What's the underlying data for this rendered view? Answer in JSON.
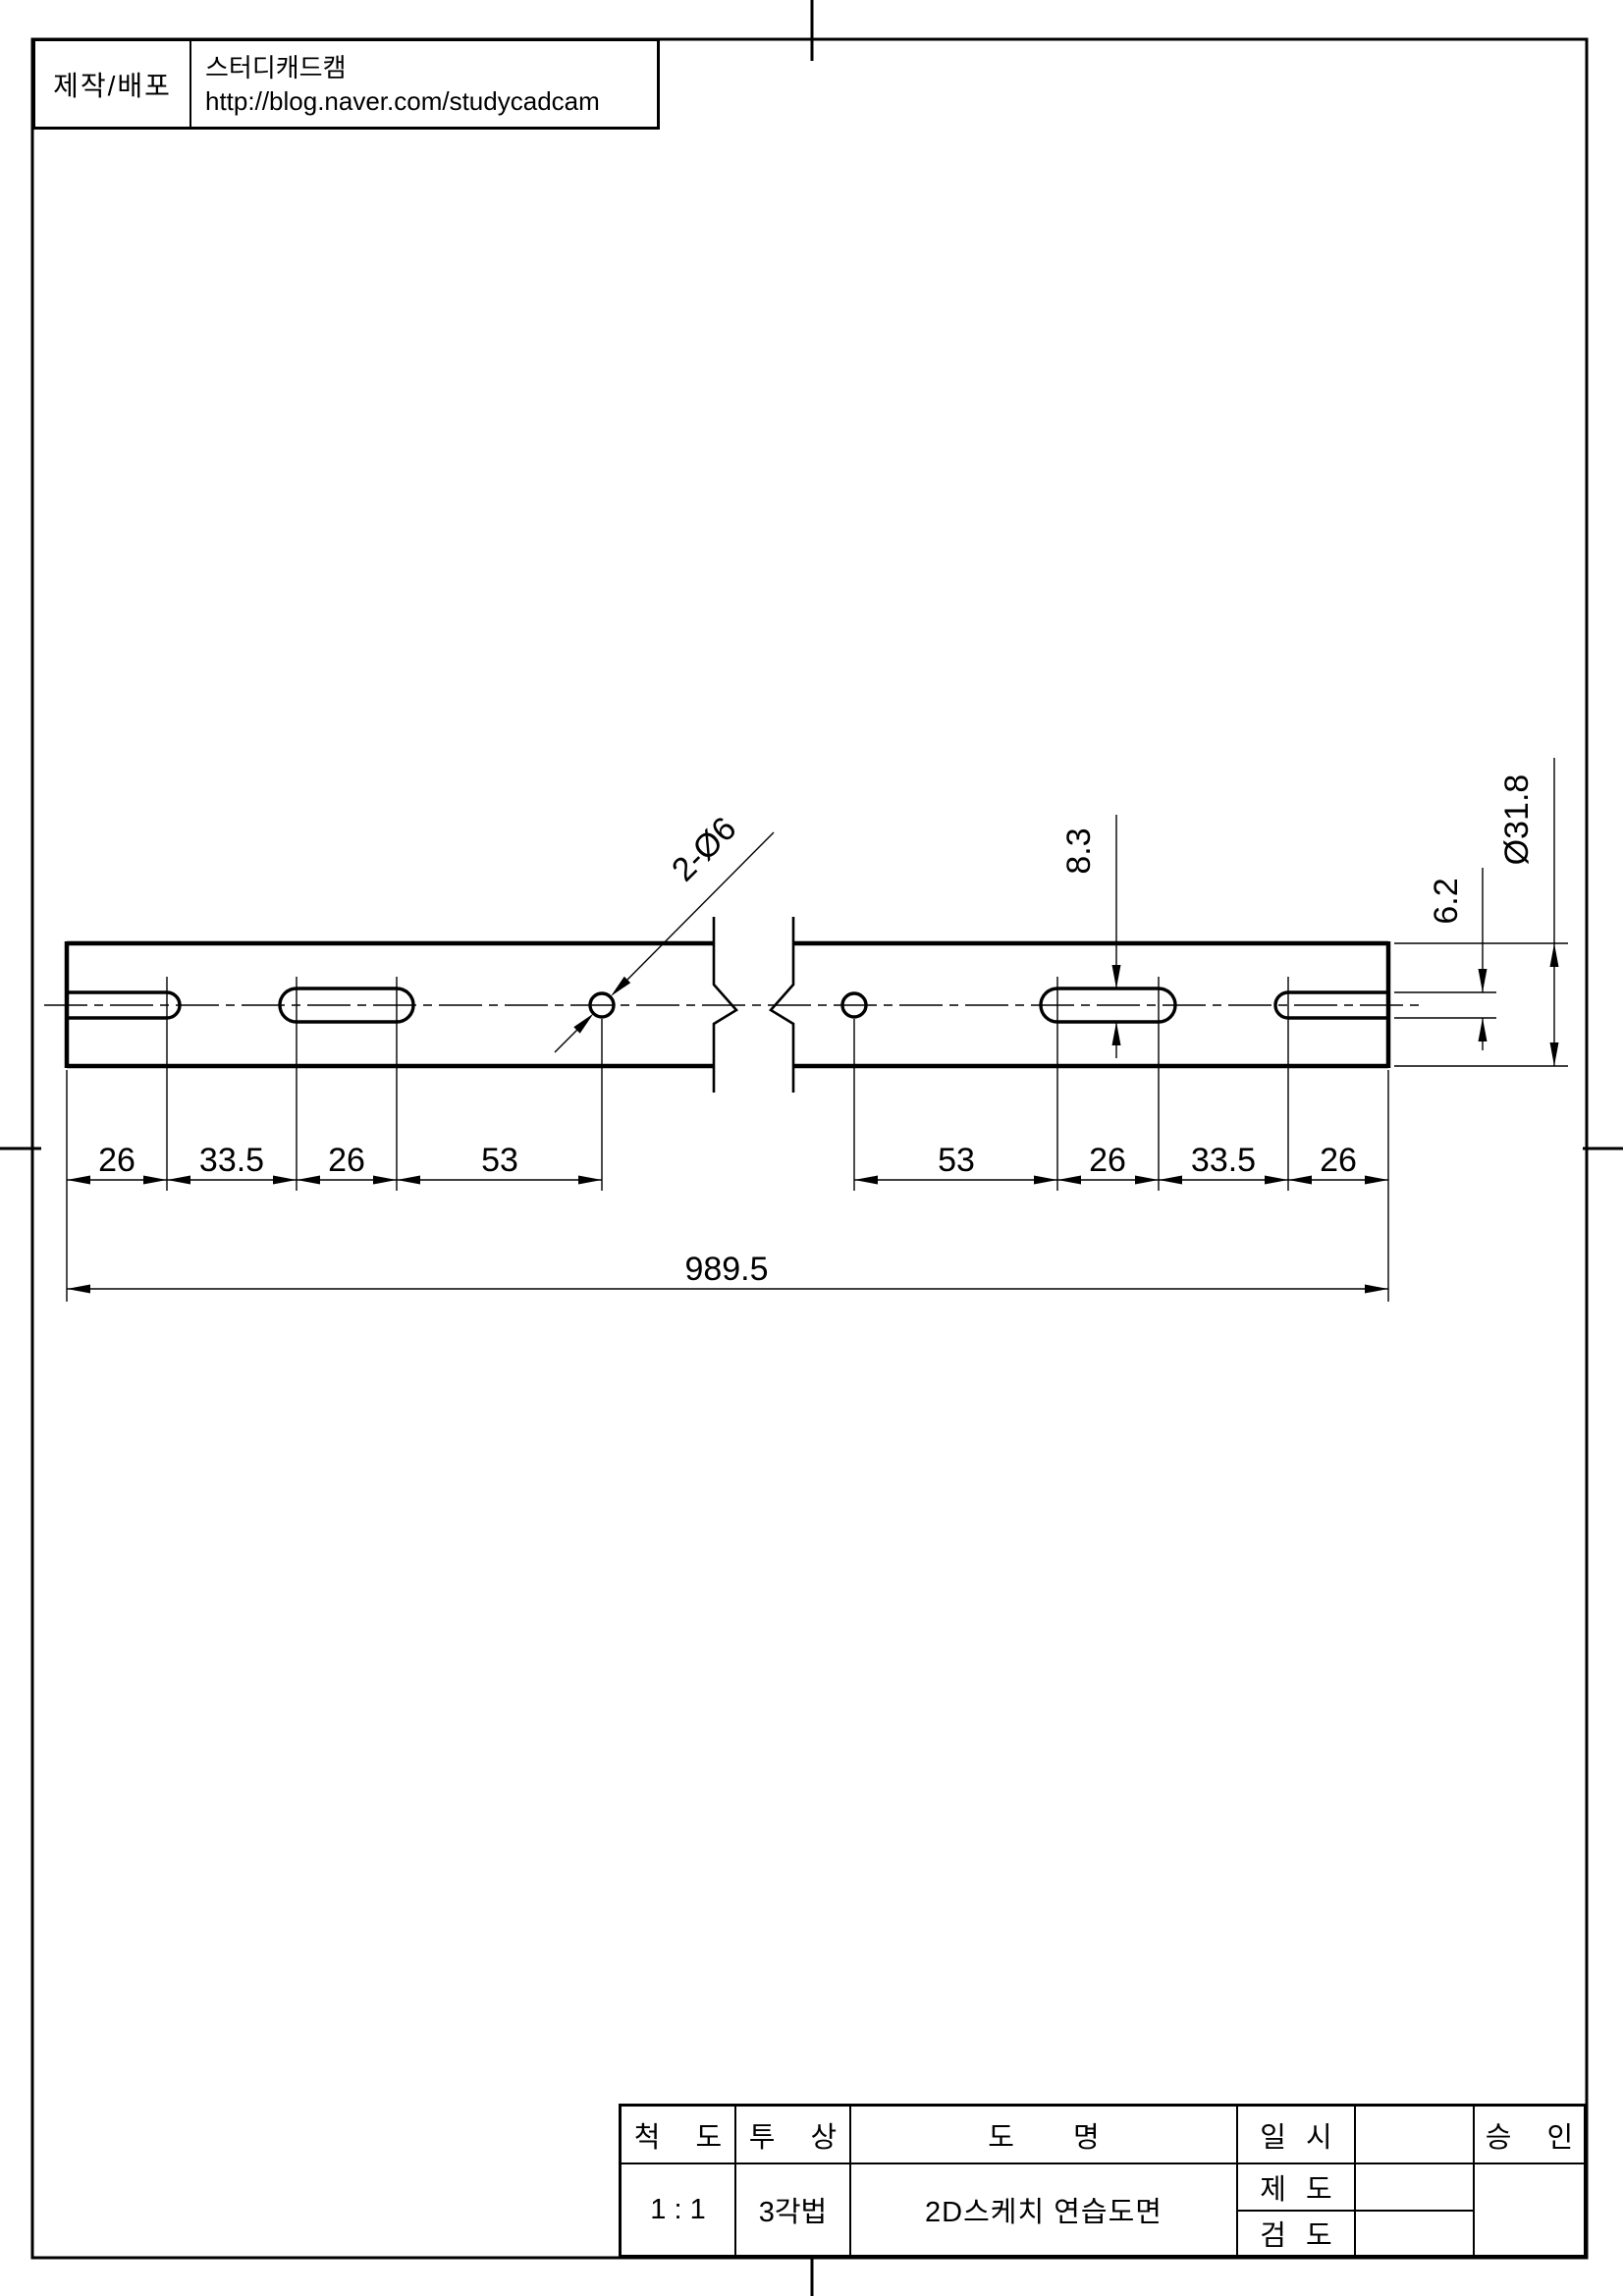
{
  "page": {
    "background": "#ffffff",
    "line_color": "#000000"
  },
  "publisher_block": {
    "label": "제작/배포",
    "name": "스터디캐드캠",
    "url": "http://blog.naver.com/studycadcam"
  },
  "drawing": {
    "dims": {
      "seg_left": [
        "26",
        "33.5",
        "26",
        "53"
      ],
      "seg_right": [
        "53",
        "26",
        "33.5",
        "26"
      ],
      "overall": "989.5",
      "mid_slot_height": "8.3",
      "end_slot_height": "6.2",
      "outer_diameter": "Ø31.8",
      "hole_callout": "2-Ø6"
    }
  },
  "title_block": {
    "scale_label": "척 도",
    "scale_value": "1 : 1",
    "projection_label": "투 상",
    "projection_value": "3각법",
    "name_label": "도 명",
    "name_value": "2D스케치 연습도면",
    "date_label": "일 시",
    "draft_label": "제 도",
    "check_label": "검 도",
    "approve_label": "승 인"
  }
}
